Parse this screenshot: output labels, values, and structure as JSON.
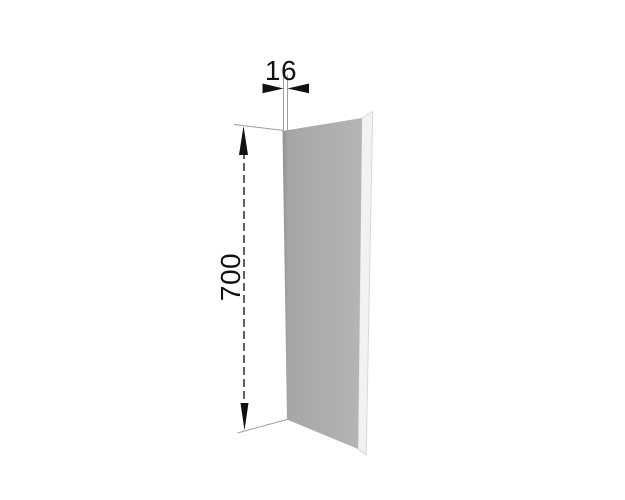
{
  "figure": {
    "kind": "technical-dimension-drawing",
    "subject": "cabinet end panel shown in perspective",
    "background": "#ffffff"
  },
  "dimensions": {
    "thickness_label": "16",
    "height_label": "700"
  },
  "colors": {
    "panel_face_left": "#909090",
    "panel_face_mid": "#a6a6a6",
    "panel_face_right": "#b5b5b5",
    "panel_edge_fill": "#f2f2f2",
    "panel_edge_border": "#d8d8d8",
    "dimension_line": "#1c1c1c",
    "extension_line": "#9e9e9e",
    "arrow_fill": "#111111",
    "label_color": "#111111"
  }
}
